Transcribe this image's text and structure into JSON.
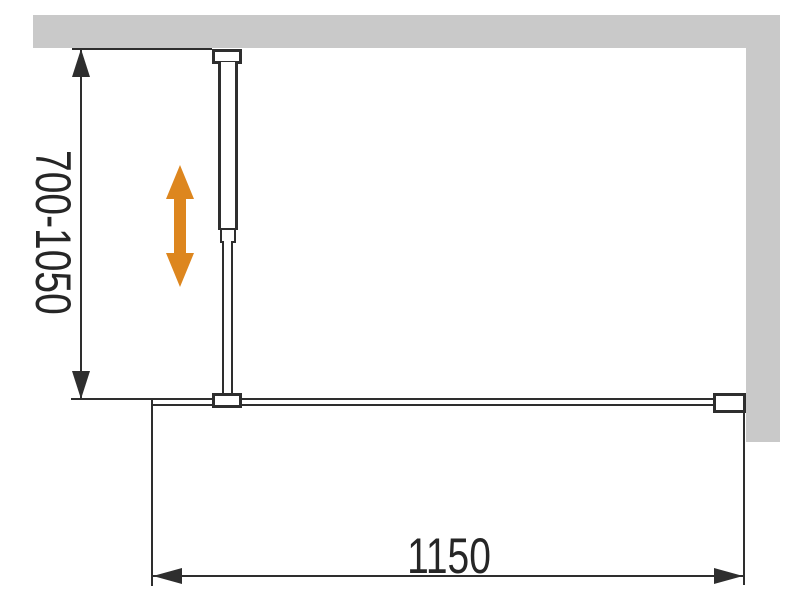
{
  "diagram": {
    "labels": {
      "vertical_dimension": "700-1050",
      "horizontal_dimension": "1150"
    },
    "colors": {
      "wall_gray": "#C9C9C9",
      "line_dark": "#2E2E2E",
      "adjust_arrow_orange": "#DD861E"
    },
    "icons": {
      "adjustability": "vertical-double-arrow-icon"
    }
  }
}
